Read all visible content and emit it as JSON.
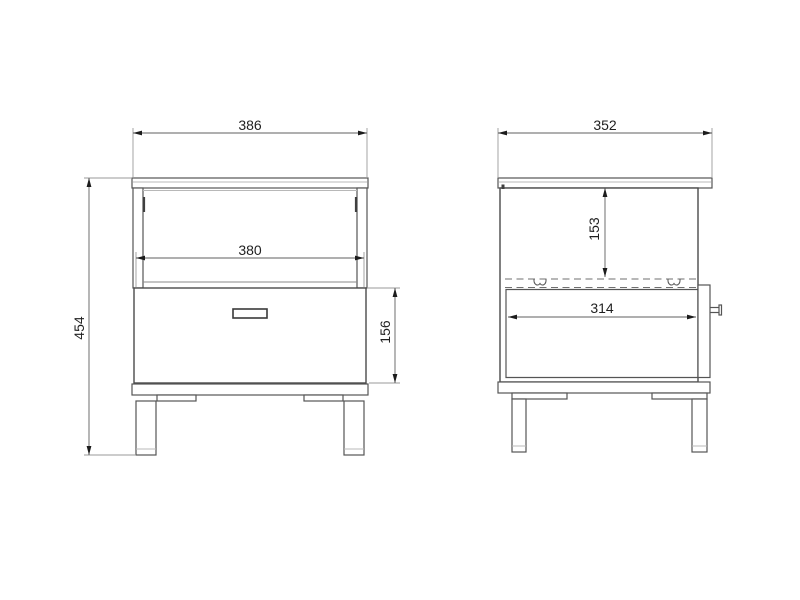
{
  "dimensions": {
    "front": {
      "overall_width": "386",
      "drawer_width": "380",
      "overall_height": "454",
      "drawer_front_height": "156"
    },
    "side": {
      "overall_depth": "352",
      "top_to_runner_height": "153",
      "runner_length": "314"
    }
  },
  "colors": {
    "background": "#ffffff",
    "object_line": "#555555",
    "dimension_line": "#5f5f5f",
    "text": "#1f1f1f"
  }
}
